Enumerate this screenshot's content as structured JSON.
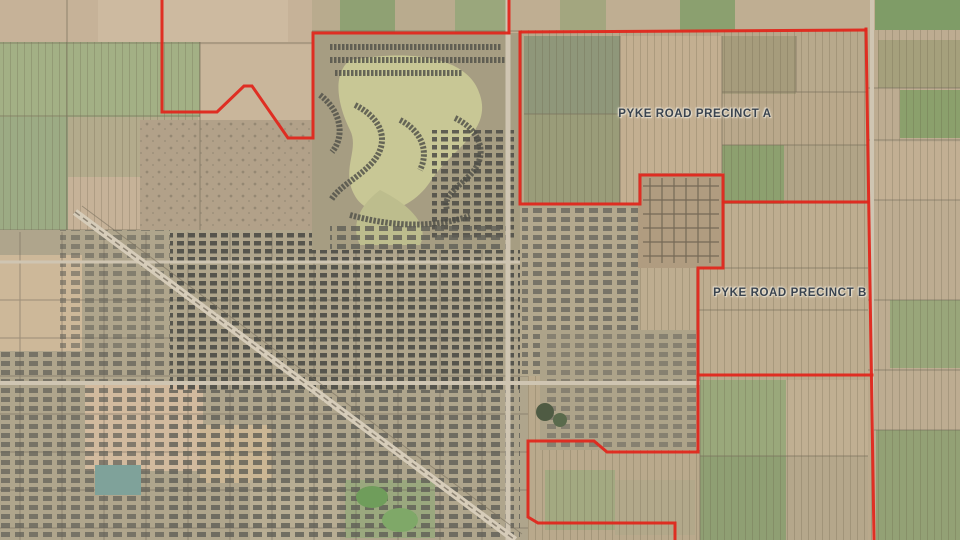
{
  "map": {
    "type": "aerial-precinct-plan",
    "labels": {
      "precinct_a": "PYKE ROAD PRECINCT A",
      "precinct_b": "PYKE ROAD PRECINCT B"
    },
    "colors": {
      "boundary": "#e0271c",
      "label_text": "#39434f",
      "label_halo": "#ded5c4"
    }
  }
}
